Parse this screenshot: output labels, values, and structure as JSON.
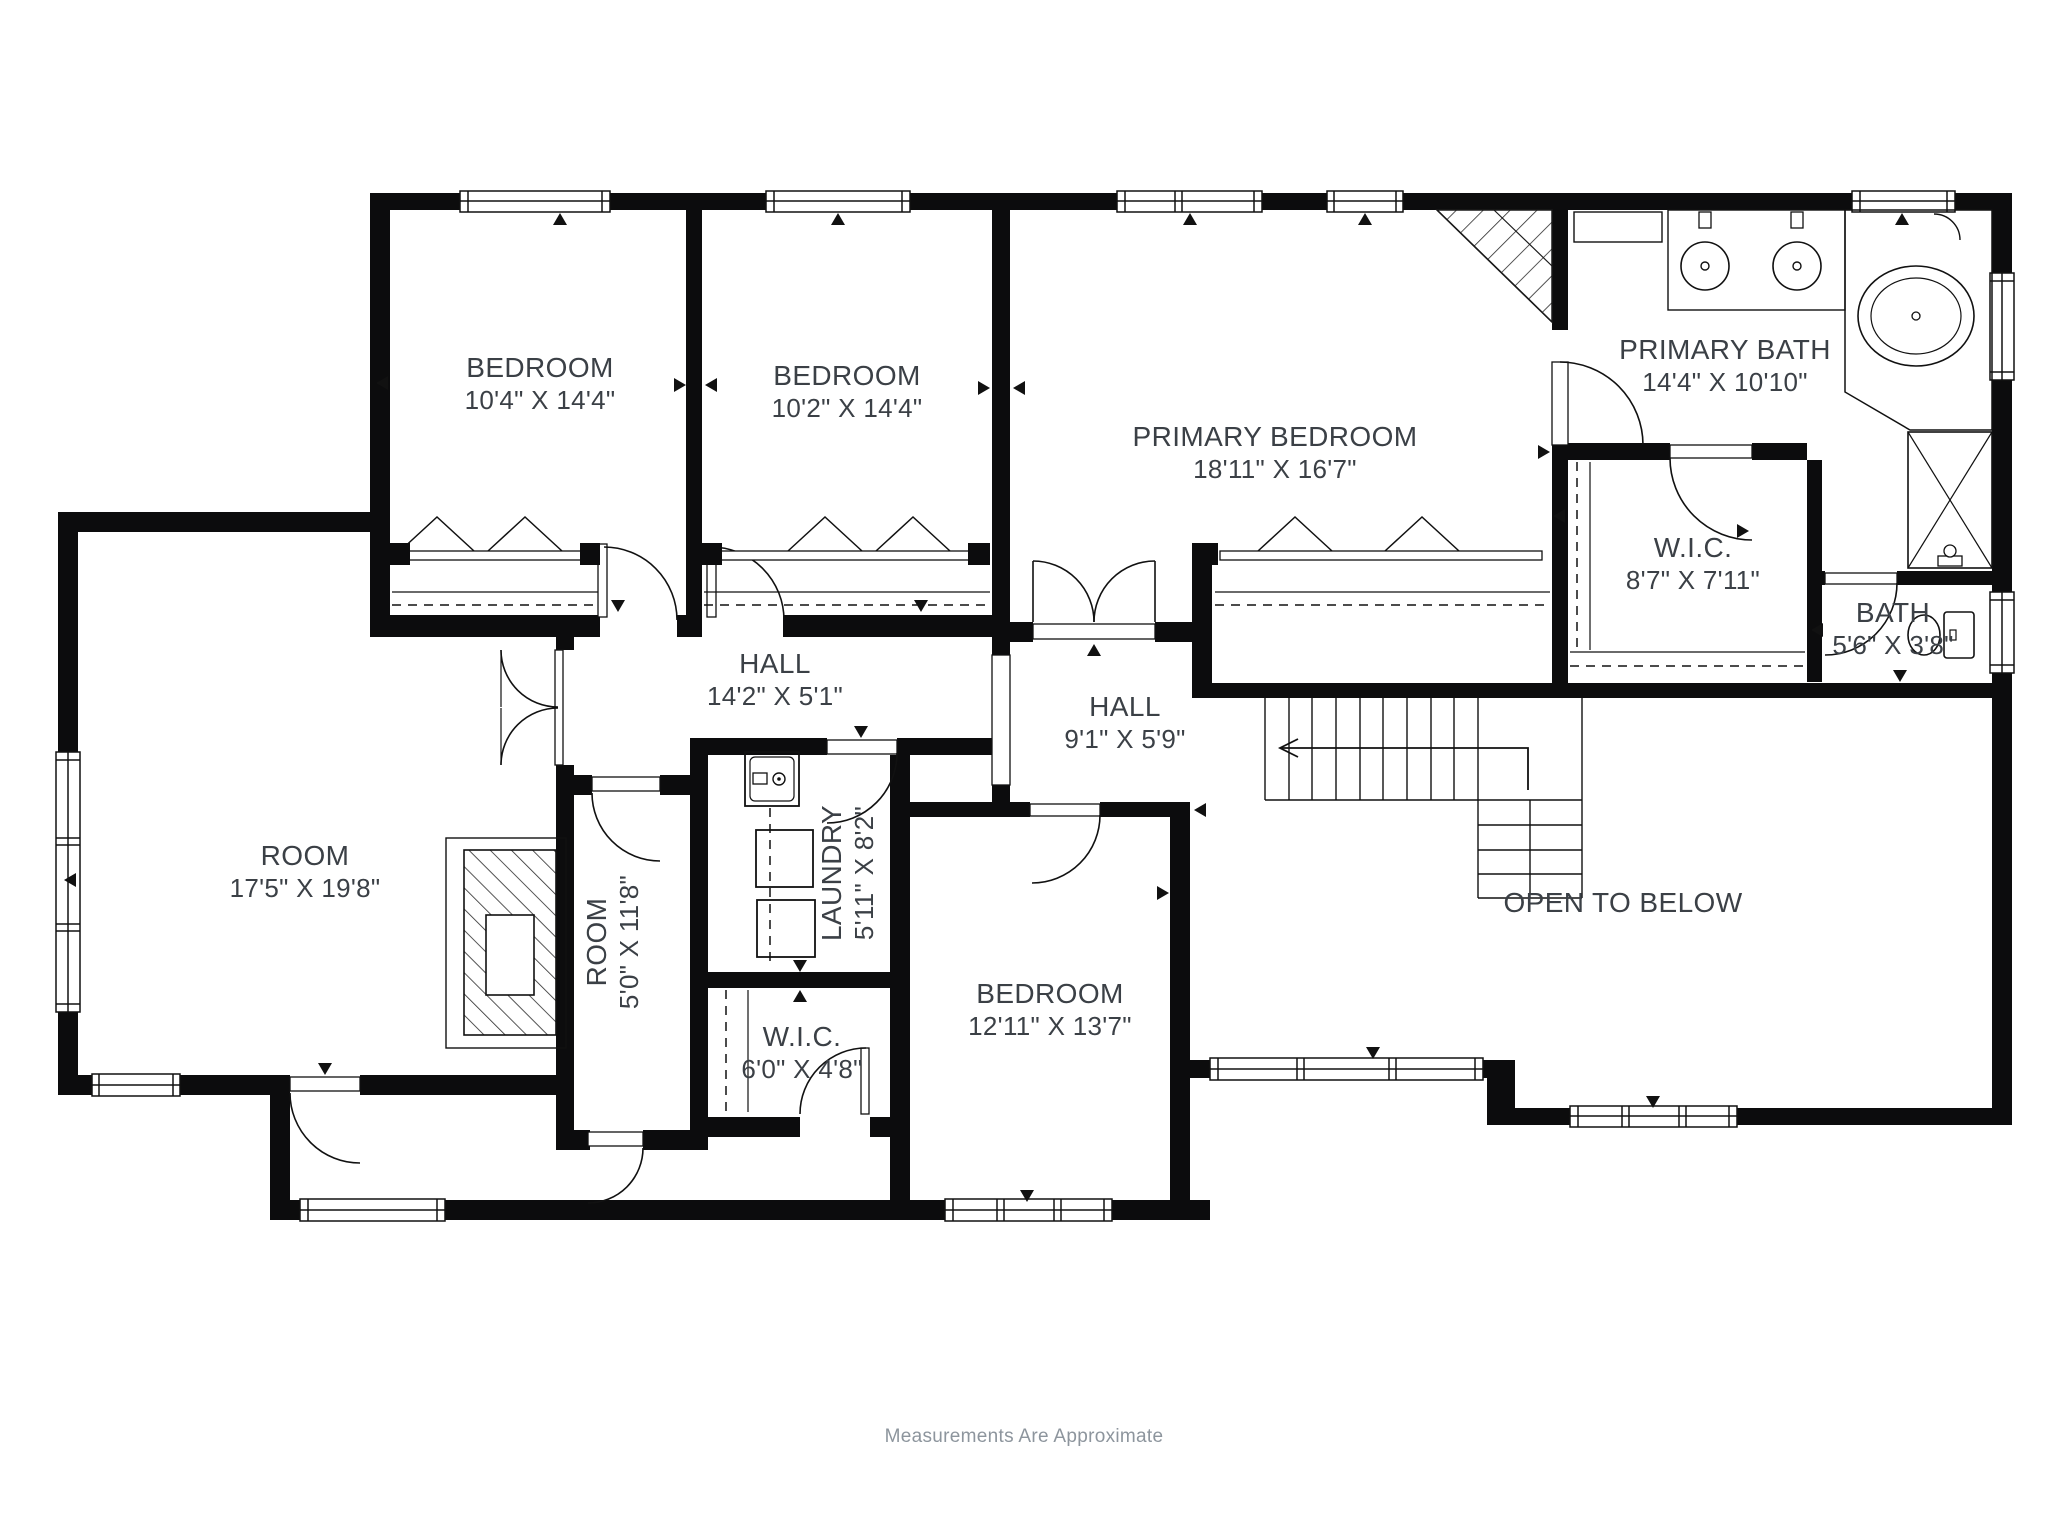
{
  "title": "Second floor plan",
  "style": {
    "background": "#ffffff",
    "ink": "#111111",
    "label_color": "#3b4046",
    "footer_color": "#8d959d"
  },
  "rooms": [
    {
      "id": "bedroom-1",
      "name": "BEDROOM",
      "dims": "10'4\" X 14'4\""
    },
    {
      "id": "bedroom-2",
      "name": "BEDROOM",
      "dims": "10'2\" X 14'4\""
    },
    {
      "id": "primary-bedroom",
      "name": "PRIMARY BEDROOM",
      "dims": "18'11\" X 16'7\""
    },
    {
      "id": "primary-bath",
      "name": "PRIMARY BATH",
      "dims": "14'4\" X 10'10\""
    },
    {
      "id": "primary-wic",
      "name": "W.I.C.",
      "dims": "8'7\" X 7'11\""
    },
    {
      "id": "bath",
      "name": "BATH",
      "dims": "5'6\" X 3'8\""
    },
    {
      "id": "hall-main",
      "name": "HALL",
      "dims": "14'2\" X 5'1\""
    },
    {
      "id": "hall-2",
      "name": "HALL",
      "dims": "9'1\" X 5'9\""
    },
    {
      "id": "room-large",
      "name": "ROOM",
      "dims": "17'5\" X 19'8\""
    },
    {
      "id": "room-small",
      "name": "ROOM",
      "dims": "5'0\" X 11'8\""
    },
    {
      "id": "laundry",
      "name": "LAUNDRY",
      "dims": "5'11\" X 8'2\""
    },
    {
      "id": "wic-small",
      "name": "W.I.C.",
      "dims": "6'0\" X 4'8\""
    },
    {
      "id": "bedroom-3",
      "name": "BEDROOM",
      "dims": "12'11\" X 13'7\""
    },
    {
      "id": "open-below",
      "name": "OPEN TO BELOW",
      "dims": ""
    }
  ],
  "fixtures": [
    "double-vanity-sinks",
    "corner-tub",
    "shower",
    "toilet",
    "laundry-sink",
    "washer",
    "dryer",
    "fireplace",
    "staircase",
    "closet-rods"
  ],
  "footer": {
    "note": "Measurements Are Approximate"
  }
}
